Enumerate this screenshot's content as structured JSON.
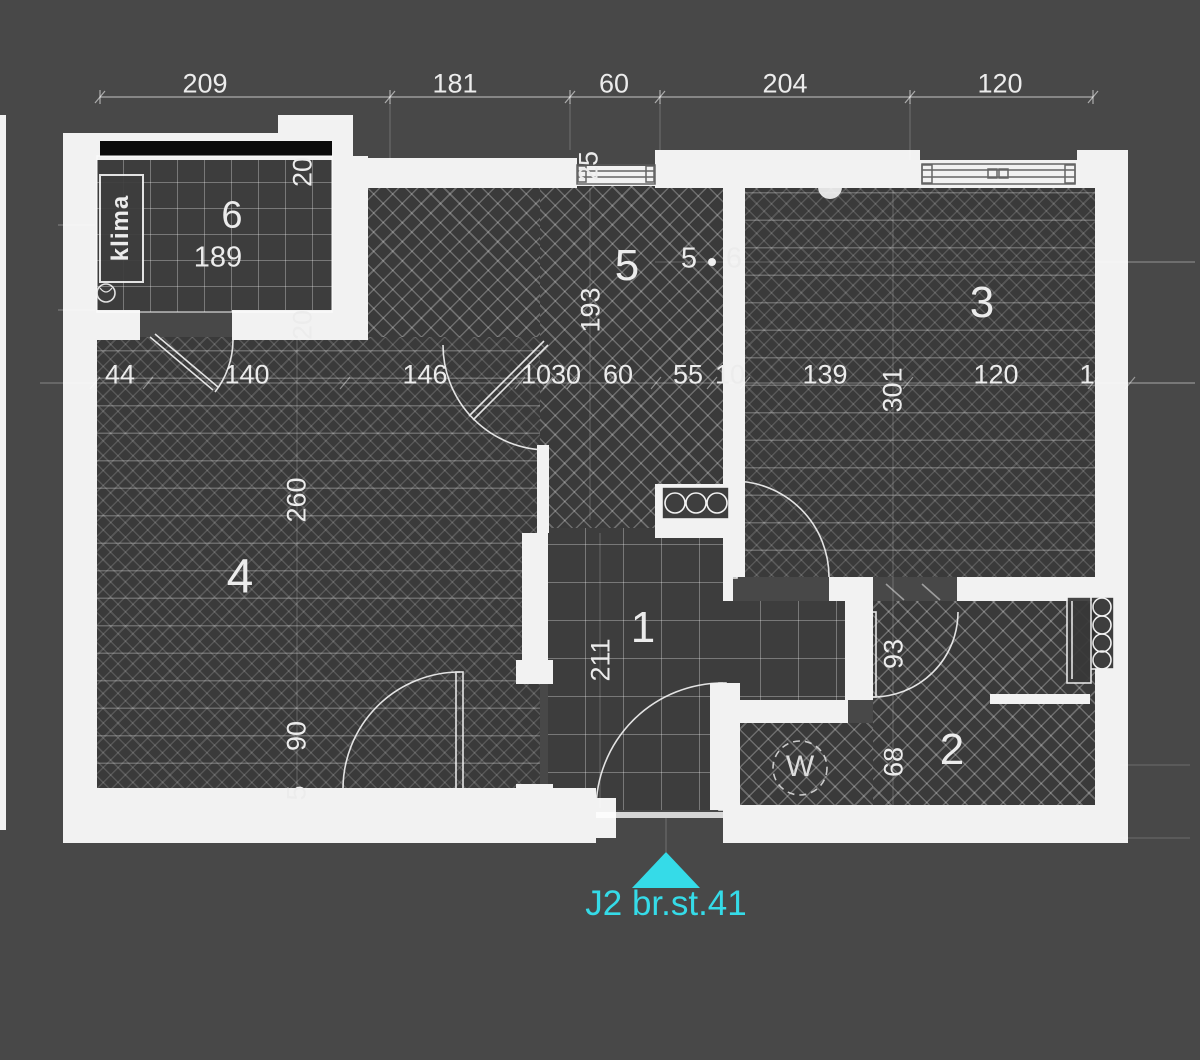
{
  "plan": {
    "unit_label": "J2 br.st.41",
    "marker_color": "#35dbe8",
    "background_color": "#484848",
    "wall_color": "#f2f2f2",
    "floor_color": "#3a3a3a",
    "room_numbers": [
      "1",
      "2",
      "3",
      "4",
      "5",
      "6"
    ],
    "fixtures": {
      "air_conditioner": "klima",
      "washing_machine": "W"
    },
    "dimensions_top": [
      "209",
      "181",
      "60",
      "204",
      "120"
    ],
    "dimensions_middle": [
      "44",
      "140",
      "146",
      "1030",
      "60",
      "55",
      "10",
      "139",
      "120",
      "1"
    ],
    "dimensions_vertical": [
      "20",
      "20",
      "25",
      "193",
      "260",
      "211",
      "90",
      "5",
      "301",
      "93",
      "68"
    ],
    "labels": [
      {
        "text": "209",
        "x": 205,
        "y": 84,
        "cls": "dim",
        "name": "dim-209"
      },
      {
        "text": "181",
        "x": 455,
        "y": 84,
        "cls": "dim",
        "name": "dim-181"
      },
      {
        "text": "60",
        "x": 614,
        "y": 84,
        "cls": "dim",
        "name": "dim-60-top"
      },
      {
        "text": "204",
        "x": 785,
        "y": 84,
        "cls": "dim",
        "name": "dim-204"
      },
      {
        "text": "120",
        "x": 1000,
        "y": 84,
        "cls": "dim",
        "name": "dim-120-top"
      },
      {
        "text": "44",
        "x": 120,
        "y": 375,
        "cls": "dim",
        "name": "dim-44"
      },
      {
        "text": "140",
        "x": 247,
        "y": 375,
        "cls": "dim",
        "name": "dim-140"
      },
      {
        "text": "146",
        "x": 425,
        "y": 375,
        "cls": "dim",
        "name": "dim-146"
      },
      {
        "text": "1030",
        "x": 551,
        "y": 375,
        "cls": "dim",
        "name": "dim-1030"
      },
      {
        "text": "60",
        "x": 618,
        "y": 375,
        "cls": "dim",
        "name": "dim-60-mid"
      },
      {
        "text": "55",
        "x": 688,
        "y": 375,
        "cls": "dim",
        "name": "dim-55"
      },
      {
        "text": "10",
        "x": 730,
        "y": 375,
        "cls": "dim",
        "name": "dim-10"
      },
      {
        "text": "139",
        "x": 825,
        "y": 375,
        "cls": "dim",
        "name": "dim-139"
      },
      {
        "text": "120",
        "x": 996,
        "y": 375,
        "cls": "dim",
        "name": "dim-120-mid"
      },
      {
        "text": "1",
        "x": 1087,
        "y": 375,
        "cls": "dim",
        "name": "dim-cutoff"
      },
      {
        "text": "20",
        "x": 303,
        "y": 172,
        "rot": -90,
        "cls": "dim-v",
        "name": "dim-20-a"
      },
      {
        "text": "20",
        "x": 303,
        "y": 325,
        "rot": -90,
        "cls": "dim-v",
        "name": "dim-20-b"
      },
      {
        "text": "25",
        "x": 589,
        "y": 166,
        "rot": -90,
        "cls": "dim-v",
        "name": "dim-25"
      },
      {
        "text": "193",
        "x": 591,
        "y": 310,
        "rot": -90,
        "cls": "dim-v",
        "name": "dim-193"
      },
      {
        "text": "260",
        "x": 297,
        "y": 500,
        "rot": -90,
        "cls": "dim-v",
        "name": "dim-260"
      },
      {
        "text": "211",
        "x": 601,
        "y": 660,
        "rot": -90,
        "cls": "dim-v",
        "name": "dim-211"
      },
      {
        "text": "90",
        "x": 297,
        "y": 736,
        "rot": -90,
        "cls": "dim-v",
        "name": "dim-90"
      },
      {
        "text": "5",
        "x": 297,
        "y": 793,
        "rot": -90,
        "cls": "dim-v",
        "name": "dim-5-v"
      },
      {
        "text": "301",
        "x": 893,
        "y": 390,
        "rot": -90,
        "cls": "dim-v",
        "name": "dim-301"
      },
      {
        "text": "93",
        "x": 894,
        "y": 654,
        "rot": -90,
        "cls": "dim-v",
        "name": "dim-93"
      },
      {
        "text": "68",
        "x": 894,
        "y": 762,
        "rot": -90,
        "cls": "dim-v",
        "name": "dim-68"
      },
      {
        "text": "5",
        "x": 689,
        "y": 259,
        "cls": "sub",
        "name": "dim-5-pair"
      },
      {
        "text": "6",
        "x": 734,
        "y": 259,
        "cls": "sub",
        "name": "dim-6-pair"
      },
      {
        "text": "6",
        "x": 232,
        "y": 216,
        "cls": "room-md",
        "name": "room-number-6"
      },
      {
        "text": "189",
        "x": 218,
        "y": 258,
        "cls": "sub",
        "name": "dim-189"
      },
      {
        "text": "5",
        "x": 627,
        "y": 266,
        "cls": "room",
        "name": "room-number-5"
      },
      {
        "text": "3",
        "x": 982,
        "y": 303,
        "cls": "room",
        "name": "room-number-3"
      },
      {
        "text": "4",
        "x": 240,
        "y": 577,
        "cls": "room-lg",
        "name": "room-number-4"
      },
      {
        "text": "1",
        "x": 643,
        "y": 628,
        "cls": "room",
        "name": "room-number-1"
      },
      {
        "text": "2",
        "x": 952,
        "y": 750,
        "cls": "room",
        "name": "room-number-2"
      },
      {
        "text": "klima",
        "x": 121,
        "y": 228,
        "rot": -90,
        "cls": "klima",
        "name": "klima-label"
      },
      {
        "text": "W",
        "x": 800,
        "y": 767,
        "cls": "w-label",
        "name": "washing-machine-label"
      }
    ]
  }
}
